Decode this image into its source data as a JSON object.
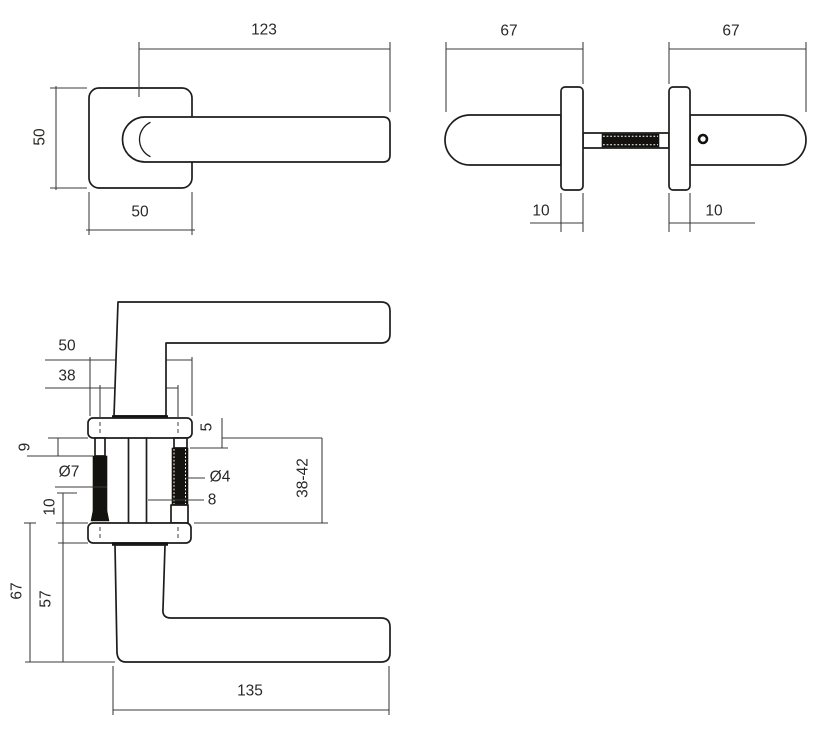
{
  "colors": {
    "line": "#1d1d1b",
    "dimension": "#3c3a38",
    "background": "#ffffff"
  },
  "views": {
    "front": {
      "dims": {
        "lever_length": "123",
        "rose_height": "50",
        "rose_width": "50"
      }
    },
    "side": {
      "dims": {
        "depth_left": "67",
        "depth_right": "67",
        "rose_thickness_left": "10",
        "rose_thickness_right": "10"
      }
    },
    "section": {
      "dims": {
        "rose_width": "50",
        "screw_spacing": "38",
        "sleeve_length": "9",
        "sleeve_diameter": "Ø7",
        "rose_offset": "10",
        "boss_height": "5",
        "screw_diameter": "Ø4",
        "spindle_size": "8",
        "door_thickness_range": "38-42",
        "handle_depth": "67",
        "lever_offset": "57",
        "lever_length": "135"
      }
    }
  }
}
